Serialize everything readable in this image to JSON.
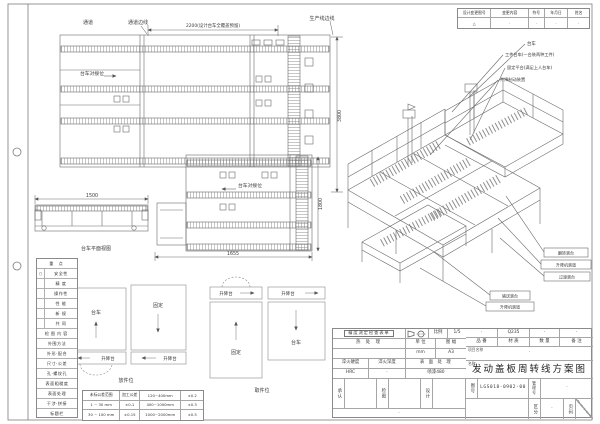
{
  "sheet": {
    "background": "#ffffff",
    "line_color": "#6a6a6a",
    "text_color": "#3a3a3a"
  },
  "revision_table": {
    "headers": [
      "设计变更图号",
      "变更内容",
      "符号",
      "年月日",
      "姓名"
    ],
    "rows": [
      [
        "△",
        "·",
        "·",
        "·",
        "·"
      ]
    ]
  },
  "plan_view_top": {
    "label_passage": "通道",
    "label_passage_edge": "通道边线",
    "label_production_edge": "生产线边线",
    "label_dock": "台车对接位",
    "dim_top": "2200(设计台车全覆盖预留)",
    "dim_right": "3800"
  },
  "plan_view_mid": {
    "label_dock": "台车对接位",
    "dim_bottom": "1655",
    "dim_right": "1800"
  },
  "side_view": {
    "dim_top": "1500",
    "caption": "台车平面视图"
  },
  "schematic": {
    "cart": "台车",
    "fixed": "固定",
    "lift": "升降台",
    "left_caption": "放件位",
    "right_caption": "取件位"
  },
  "iso_view": {
    "leader_labels": [
      "台车",
      "工件台车(一台装两种工件)",
      "固定平台(满足上人台车)",
      "升降制动装置"
    ],
    "boxed_labels_right": [
      "翻转滚台",
      "升降机滚道",
      "过渡滚台"
    ],
    "boxed_labels_lower": [
      "输送滚台",
      "升降机滚道"
    ]
  },
  "checklist": {
    "rows": [
      {
        "mark": "",
        "label": "重 点"
      },
      {
        "mark": "○",
        "label": "安全性"
      },
      {
        "mark": "",
        "label": "精 度"
      },
      {
        "mark": "",
        "label": "操作性"
      },
      {
        "mark": "",
        "label": "性 能"
      },
      {
        "mark": "",
        "label": "新 规"
      },
      {
        "mark": "",
        "label": "共 同"
      },
      {
        "label": "检图内容"
      },
      {
        "label": "外围方法"
      },
      {
        "label": "外形·配合"
      },
      {
        "label": "尺寸·公差"
      },
      {
        "label": "孔·螺纹孔"
      },
      {
        "label": "表面粗糙度"
      },
      {
        "label": "表面处理"
      },
      {
        "label": "干涉·拼接"
      },
      {
        "label": "标题栏"
      }
    ]
  },
  "tolerance_table": {
    "rows": [
      [
        "未标公差范围",
        "加工公差",
        "120~400mm",
        "±0.2"
      ],
      [
        "1 ~ 30 mm",
        "±0.1",
        "400~1000mm",
        "±0.3"
      ],
      [
        "30 ~ 100 mm",
        "±0.15",
        "1000~2000mm",
        "±0.5"
      ]
    ]
  },
  "title_block": {
    "inspection_sheet": "精度测定检查表单",
    "scale_label": "比例",
    "scale_value": "1/5",
    "heat_treatment": "热 处 理",
    "unit_label": "单 位",
    "unit_value": "mm",
    "format_label": "图 幅",
    "format_value": "A3",
    "quench_hardness_label": "淬火硬度",
    "quench_hardness_value": "HRC",
    "quench_depth_label": "淬火深度",
    "quench_depth_value": "·",
    "surface_label": "表 面 处 理",
    "surface_value": "喷漆480",
    "part_no_label": "品 番",
    "part_no_value": "·",
    "material_label": "材 质",
    "material_value": "Q235",
    "qty_label": "数 量",
    "qty_value": "·",
    "remark_label": "备 注",
    "remark_value": "·",
    "project_label": "项目名称",
    "project_value": "·",
    "name_label": "名称",
    "title": "发动盖板周转线方案图",
    "approve_label": "承认",
    "check_label": "检图",
    "design_label": "设计",
    "drawing_no_label": "图号",
    "drawing_no": "LGS018-0902-00",
    "manage_no_label": "管理号",
    "manage_no_value": "·",
    "division_label": "区分",
    "division_value": "·",
    "page_label": "页码",
    "page_value": "·",
    "footer_dot": "·"
  }
}
